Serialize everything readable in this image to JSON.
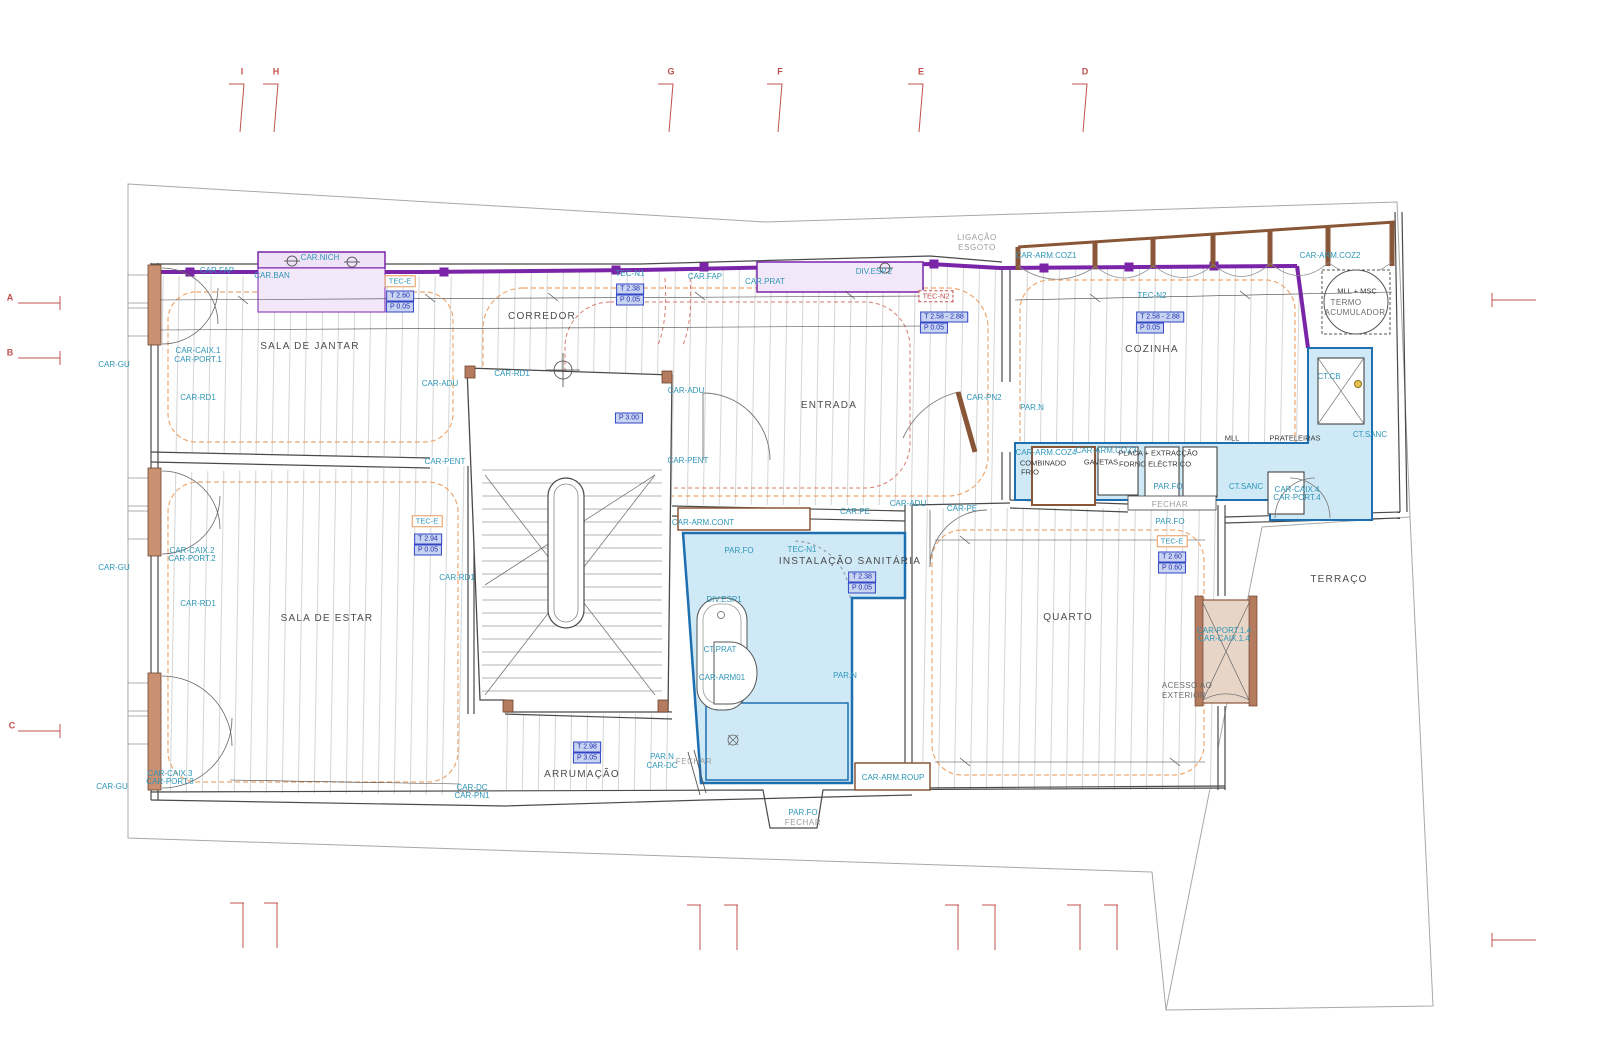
{
  "meta": {
    "drawing_type": "architectural floor plan",
    "width": 1600,
    "height": 1063
  },
  "colors": {
    "label_cyan": "#2e96b8",
    "room_text": "#4c4c4c",
    "note_gray": "#9c9c9c",
    "value_box_blue": "#3347c4",
    "tec_box_orange": "#e8995c",
    "grid_marker_red": "#c0504d",
    "wall_brown": "#8a5638",
    "wall_brown_fill": "#b57b5e",
    "wet_area_fill": "#cfe9f6",
    "wet_area_stroke": "#1d6fb0",
    "cabinet_lilac_fill": "#efe2f7",
    "cabinet_purple": "#7a24a8",
    "ceiling_orange_dash": "#efa86f",
    "red_dash": "#d97b6c",
    "floor_board_gray": "#d5d5d5"
  },
  "grid_markers": {
    "top_letters": [
      "I",
      "H",
      "G",
      "F",
      "E",
      "D"
    ],
    "left_letters": [
      "A",
      "B",
      "C"
    ]
  },
  "rooms": [
    "SALA DE JANTAR",
    "CORREDOR",
    "ENTRADA",
    "COZINHA",
    "SALA DE ESTAR",
    "INSTALAÇÃO SANITÁRIA",
    "QUARTO",
    "ARRUMAÇÃO",
    "TERRAÇO"
  ],
  "labels": [
    {
      "text": "CAR.FAP",
      "x": 217,
      "y": 271,
      "style": "code"
    },
    {
      "text": "CAR.BAN",
      "x": 272,
      "y": 276,
      "style": "code"
    },
    {
      "text": "CAR.NICH",
      "x": 320,
      "y": 258,
      "style": "code"
    },
    {
      "text": "TEC-E",
      "x": 400,
      "y": 281,
      "style": "boxorange"
    },
    {
      "text": "T 2.60",
      "x": 400,
      "y": 296,
      "style": "boxblue"
    },
    {
      "text": "P 0.05",
      "x": 400,
      "y": 307,
      "style": "boxblue"
    },
    {
      "text": "CORREDOR",
      "x": 542,
      "y": 317,
      "style": "room"
    },
    {
      "text": "TEC-N1",
      "x": 630,
      "y": 274,
      "style": "code"
    },
    {
      "text": "T 2.38",
      "x": 630,
      "y": 289,
      "style": "boxblue"
    },
    {
      "text": "P 0.05",
      "x": 630,
      "y": 300,
      "style": "boxblue"
    },
    {
      "text": "CAR.FAP",
      "x": 705,
      "y": 277,
      "style": "code"
    },
    {
      "text": "CAR.PRAT",
      "x": 765,
      "y": 282,
      "style": "code"
    },
    {
      "text": "DIV.ESP.2",
      "x": 874,
      "y": 272,
      "style": "code"
    },
    {
      "text": "LIGAÇÃO",
      "x": 977,
      "y": 238,
      "style": "gray"
    },
    {
      "text": "ESGOTO",
      "x": 977,
      "y": 248,
      "style": "gray"
    },
    {
      "text": "CAR-ARM.COZ1",
      "x": 1046,
      "y": 256,
      "style": "code"
    },
    {
      "text": "CAR-ARM.COZ2",
      "x": 1330,
      "y": 256,
      "style": "code"
    },
    {
      "text": "TEC-N2",
      "x": 936,
      "y": 296,
      "style": "boxred"
    },
    {
      "text": "T 2.58 - 2.88",
      "x": 944,
      "y": 317,
      "style": "boxblue"
    },
    {
      "text": "P 0.05",
      "x": 934,
      "y": 328,
      "style": "boxblue"
    },
    {
      "text": "TEC-N2",
      "x": 1152,
      "y": 296,
      "style": "code"
    },
    {
      "text": "T 2.58 - 2.88",
      "x": 1160,
      "y": 317,
      "style": "boxblue"
    },
    {
      "text": "P 0.05",
      "x": 1150,
      "y": 328,
      "style": "boxblue"
    },
    {
      "text": "MLL + MSC",
      "x": 1357,
      "y": 291,
      "style": "dark"
    },
    {
      "text": "TERMO",
      "x": 1346,
      "y": 303,
      "style": "roomsm"
    },
    {
      "text": "ACUMULADOR",
      "x": 1355,
      "y": 313,
      "style": "roomsm"
    },
    {
      "text": "SALA DE JANTAR",
      "x": 310,
      "y": 347,
      "style": "room"
    },
    {
      "text": "COZINHA",
      "x": 1152,
      "y": 350,
      "style": "room"
    },
    {
      "text": "CT.CB",
      "x": 1329,
      "y": 377,
      "style": "code"
    },
    {
      "text": "CAR-CAIX.1",
      "x": 198,
      "y": 351,
      "style": "code"
    },
    {
      "text": "CAR-PORT.1",
      "x": 198,
      "y": 360,
      "style": "code"
    },
    {
      "text": "CAR-GU",
      "x": 114,
      "y": 365,
      "style": "code"
    },
    {
      "text": "CAR-RD1",
      "x": 198,
      "y": 398,
      "style": "code"
    },
    {
      "text": "CAR-ADU",
      "x": 440,
      "y": 384,
      "style": "code"
    },
    {
      "text": "CAR-RD1",
      "x": 512,
      "y": 374,
      "style": "code"
    },
    {
      "text": "CAR-ADU",
      "x": 686,
      "y": 391,
      "style": "code"
    },
    {
      "text": "P 3.00",
      "x": 629,
      "y": 418,
      "style": "boxblue"
    },
    {
      "text": "ENTRADA",
      "x": 829,
      "y": 406,
      "style": "room"
    },
    {
      "text": "CAR-PN2",
      "x": 984,
      "y": 398,
      "style": "code"
    },
    {
      "text": "PAR.N",
      "x": 1032,
      "y": 408,
      "style": "code"
    },
    {
      "text": "CAR-PENT",
      "x": 445,
      "y": 462,
      "style": "code"
    },
    {
      "text": "CAR-PENT",
      "x": 688,
      "y": 461,
      "style": "code"
    },
    {
      "text": "CAR-ARM.COZ4",
      "x": 1046,
      "y": 453,
      "style": "code"
    },
    {
      "text": "COMBINADO",
      "x": 1043,
      "y": 463,
      "style": "dark"
    },
    {
      "text": "FRIO",
      "x": 1030,
      "y": 472,
      "style": "dark"
    },
    {
      "text": "CAR-ARM.COZ3",
      "x": 1106,
      "y": 451,
      "style": "code"
    },
    {
      "text": "GAVETAS",
      "x": 1101,
      "y": 462,
      "style": "dark"
    },
    {
      "text": "PLACA + EXTRACÇÃO",
      "x": 1158,
      "y": 453,
      "style": "dark"
    },
    {
      "text": "FORNO ELÉCTRICO",
      "x": 1155,
      "y": 464,
      "style": "dark"
    },
    {
      "text": "MLL",
      "x": 1232,
      "y": 438,
      "style": "dark"
    },
    {
      "text": "PRATELEIRAS",
      "x": 1295,
      "y": 438,
      "style": "dark"
    },
    {
      "text": "PAR.FO",
      "x": 1168,
      "y": 487,
      "style": "code"
    },
    {
      "text": "FECHAR",
      "x": 1170,
      "y": 505,
      "style": "gray"
    },
    {
      "text": "CT.SANC",
      "x": 1246,
      "y": 487,
      "style": "code"
    },
    {
      "text": "CT.SANC",
      "x": 1370,
      "y": 435,
      "style": "code"
    },
    {
      "text": "CAR-CAIX.4",
      "x": 1297,
      "y": 490,
      "style": "code"
    },
    {
      "text": "CAR-PORT.4",
      "x": 1297,
      "y": 498,
      "style": "code"
    },
    {
      "text": "CAR-ADU",
      "x": 908,
      "y": 504,
      "style": "code"
    },
    {
      "text": "CAR.PE",
      "x": 855,
      "y": 512,
      "style": "code"
    },
    {
      "text": "CAR-PE",
      "x": 962,
      "y": 509,
      "style": "code"
    },
    {
      "text": "CAR-ARM.CONT",
      "x": 703,
      "y": 523,
      "style": "code"
    },
    {
      "text": "PAR.FO",
      "x": 739,
      "y": 551,
      "style": "code"
    },
    {
      "text": "TEC-N1",
      "x": 802,
      "y": 550,
      "style": "code"
    },
    {
      "text": "INSTALAÇÃO SANITÁRIA",
      "x": 850,
      "y": 562,
      "style": "room"
    },
    {
      "text": "T 2.38",
      "x": 862,
      "y": 577,
      "style": "boxblue"
    },
    {
      "text": "P 0.05",
      "x": 862,
      "y": 588,
      "style": "boxblue"
    },
    {
      "text": "DIV.ESP1",
      "x": 724,
      "y": 600,
      "style": "code"
    },
    {
      "text": "PAR.FO",
      "x": 1170,
      "y": 522,
      "style": "code"
    },
    {
      "text": "TEC-E",
      "x": 1172,
      "y": 541,
      "style": "boxorange"
    },
    {
      "text": "T 2.60",
      "x": 1172,
      "y": 557,
      "style": "boxblue"
    },
    {
      "text": "P 0.60",
      "x": 1172,
      "y": 568,
      "style": "boxblue"
    },
    {
      "text": "TEC-E",
      "x": 427,
      "y": 521,
      "style": "boxorange"
    },
    {
      "text": "T 2.94",
      "x": 428,
      "y": 539,
      "style": "boxblue"
    },
    {
      "text": "P 0.05",
      "x": 428,
      "y": 550,
      "style": "boxblue"
    },
    {
      "text": "CAR-CAIX.2",
      "x": 192,
      "y": 551,
      "style": "code"
    },
    {
      "text": "CAR-PORT.2",
      "x": 192,
      "y": 559,
      "style": "code"
    },
    {
      "text": "CAR-GU",
      "x": 114,
      "y": 568,
      "style": "code"
    },
    {
      "text": "CAR-RD1",
      "x": 198,
      "y": 604,
      "style": "code"
    },
    {
      "text": "CAR-RD1",
      "x": 457,
      "y": 578,
      "style": "code"
    },
    {
      "text": "SALA DE ESTAR",
      "x": 327,
      "y": 619,
      "style": "room"
    },
    {
      "text": "QUARTO",
      "x": 1068,
      "y": 618,
      "style": "room"
    },
    {
      "text": "TERRAÇO",
      "x": 1339,
      "y": 580,
      "style": "room"
    },
    {
      "text": "CT.PRAT",
      "x": 720,
      "y": 650,
      "style": "code"
    },
    {
      "text": "CAR-ARM01",
      "x": 722,
      "y": 678,
      "style": "code"
    },
    {
      "text": "PAR.N",
      "x": 845,
      "y": 676,
      "style": "code"
    },
    {
      "text": "CAR-PORT.1.4",
      "x": 1224,
      "y": 631,
      "style": "code"
    },
    {
      "text": "CAR-CAIX.1.4",
      "x": 1224,
      "y": 639,
      "style": "code"
    },
    {
      "text": "ACESSO AO",
      "x": 1187,
      "y": 686,
      "style": "roomsm"
    },
    {
      "text": "EXTERIOR",
      "x": 1184,
      "y": 696,
      "style": "roomsm"
    },
    {
      "text": "T 2.98",
      "x": 587,
      "y": 747,
      "style": "boxblue"
    },
    {
      "text": "P 3.05",
      "x": 587,
      "y": 758,
      "style": "boxblue"
    },
    {
      "text": "PAR.N",
      "x": 662,
      "y": 757,
      "style": "code"
    },
    {
      "text": "CAR-DC",
      "x": 662,
      "y": 766,
      "style": "code"
    },
    {
      "text": "FECHAR",
      "x": 694,
      "y": 762,
      "style": "gray"
    },
    {
      "text": "ARRUMAÇÃO",
      "x": 582,
      "y": 775,
      "style": "room"
    },
    {
      "text": "CAR-CAIX.3",
      "x": 170,
      "y": 774,
      "style": "code"
    },
    {
      "text": "CAR-PORT.3",
      "x": 170,
      "y": 782,
      "style": "code"
    },
    {
      "text": "CAR-GU",
      "x": 112,
      "y": 787,
      "style": "code"
    },
    {
      "text": "CAR-DC",
      "x": 472,
      "y": 788,
      "style": "code"
    },
    {
      "text": "CAR-PN1",
      "x": 472,
      "y": 796,
      "style": "code"
    },
    {
      "text": "CAR-ARM.ROUP",
      "x": 893,
      "y": 778,
      "style": "code"
    },
    {
      "text": "PAR.FO",
      "x": 803,
      "y": 813,
      "style": "code"
    },
    {
      "text": "FECHAR",
      "x": 803,
      "y": 823,
      "style": "gray"
    },
    {
      "text": "I",
      "x": 242,
      "y": 72,
      "style": "marker"
    },
    {
      "text": "H",
      "x": 276,
      "y": 72,
      "style": "marker"
    },
    {
      "text": "G",
      "x": 671,
      "y": 72,
      "style": "marker"
    },
    {
      "text": "F",
      "x": 780,
      "y": 72,
      "style": "marker"
    },
    {
      "text": "E",
      "x": 921,
      "y": 72,
      "style": "marker"
    },
    {
      "text": "D",
      "x": 1085,
      "y": 72,
      "style": "marker"
    },
    {
      "text": "A",
      "x": 10,
      "y": 298,
      "style": "marker"
    },
    {
      "text": "B",
      "x": 10,
      "y": 353,
      "style": "marker"
    },
    {
      "text": "C",
      "x": 12,
      "y": 726,
      "style": "marker"
    }
  ]
}
